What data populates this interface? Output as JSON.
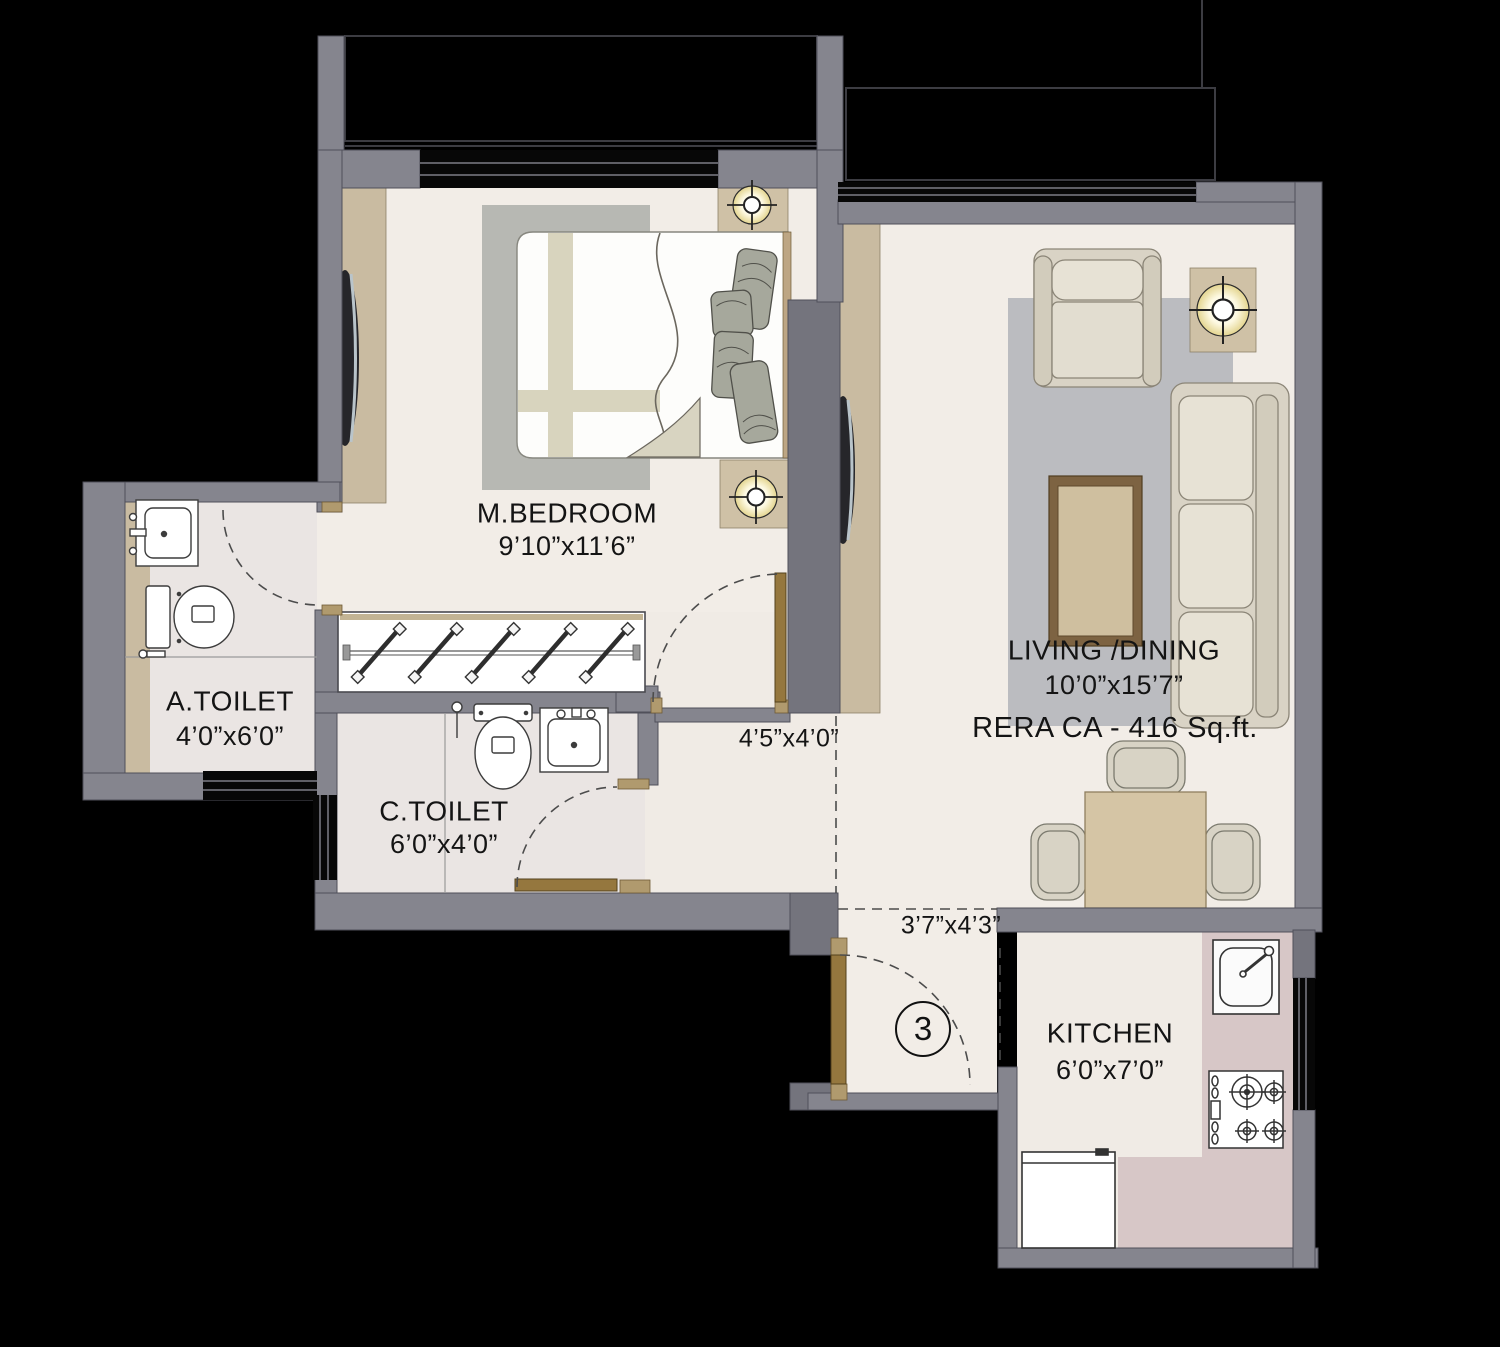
{
  "plan": {
    "rooms": {
      "master_bedroom": {
        "label": "M.BEDROOM",
        "dimensions": "9’10”x11’6”"
      },
      "attached_toilet": {
        "label": "A.TOILET",
        "dimensions": "4’0”x6’0”"
      },
      "common_toilet": {
        "label": "C.TOILET",
        "dimensions": "6’0”x4’0”"
      },
      "living_dining": {
        "label": "LIVING /DINING",
        "dimensions": "10’0”x15’7”",
        "rera_carpet_area": "RERA CA - 416 Sq.ft."
      },
      "kitchen": {
        "label": "KITCHEN",
        "dimensions": "6’0”x7’0”"
      },
      "passage": {
        "dimensions": "4’5”x4’0”"
      },
      "foyer": {
        "dimensions": "3’7”x4’3”",
        "unit_number": "3"
      }
    },
    "icons": [
      "ceiling-light-icon",
      "toilet-icon",
      "washbasin-icon",
      "kitchen-sink-icon",
      "gas-stove-icon",
      "wardrobe-hatch",
      "door-swing-arc"
    ],
    "colors": {
      "background": "#000000",
      "wall": "#85858e",
      "floor": "#f2ede7",
      "toilet_floor": "#eae5e3",
      "kitchen_counter": "#d7c7c7",
      "beige_panel": "#c9bba1",
      "door_wood": "#95773e",
      "text": "#141414"
    }
  }
}
